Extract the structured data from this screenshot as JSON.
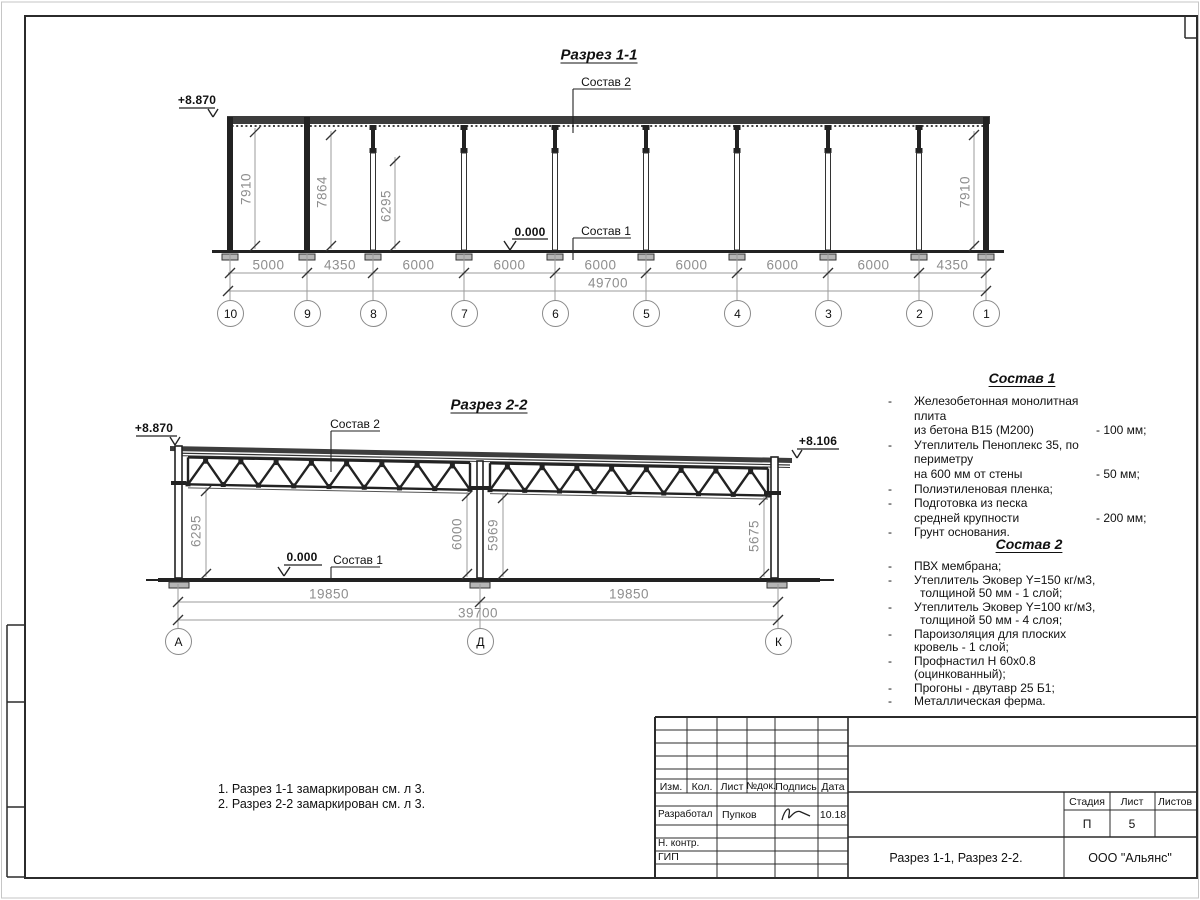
{
  "section1": {
    "title": "Разрез 1-1",
    "elevation_left": "+8.870",
    "zero_level": "0.000",
    "label_sostav2": "Состав 2",
    "label_sostav1": "Состав 1",
    "grid_labels": [
      "10",
      "9",
      "8",
      "7",
      "6",
      "5",
      "4",
      "3",
      "2",
      "1"
    ],
    "segment_dims": [
      "5000",
      "4350",
      "6000",
      "6000",
      "6000",
      "6000",
      "6000",
      "6000",
      "4350"
    ],
    "total_dim": "49700",
    "vertical_dims": [
      "7910",
      "7864",
      "6295",
      "7910"
    ]
  },
  "section2": {
    "title": "Разрез 2-2",
    "elevation_left": "+8.870",
    "elevation_right": "+8.106",
    "zero_level": "0.000",
    "label_sostav2": "Состав 2",
    "label_sostav1": "Состав 1",
    "grid_labels": [
      "А",
      "Д",
      "К"
    ],
    "segment_dims": [
      "19850",
      "19850"
    ],
    "total_dim": "39700",
    "vertical_dims": [
      "6295",
      "6000",
      "5969",
      "5675"
    ]
  },
  "sostav1": {
    "title": "Состав 1",
    "rows": [
      {
        "d": "-",
        "t": "Железобетонная  монолитная плита",
        "v": ""
      },
      {
        "d": "",
        "t": "из бетона В15 (М200)",
        "v": "- 100 мм;"
      },
      {
        "d": "-",
        "t": "Утеплитель Пеноплекс 35, по периметру",
        "v": ""
      },
      {
        "d": "",
        "t": "на 600 мм от стены",
        "v": "- 50 мм;"
      },
      {
        "d": "-",
        "t": "Полиэтиленовая пленка;",
        "v": ""
      },
      {
        "d": "-",
        "t": "Подготовка из песка",
        "v": ""
      },
      {
        "d": "",
        "t": "средней крупности",
        "v": "- 200 мм;"
      },
      {
        "d": "-",
        "t": "Грунт основания.",
        "v": ""
      }
    ]
  },
  "sostav2": {
    "title": "Состав 2",
    "rows": [
      {
        "d": "-",
        "t": "ПВХ мембрана;",
        "v": ""
      },
      {
        "d": "-",
        "t": "Утеплитель Эковер Y=150 кг/м3,",
        "v": ""
      },
      {
        "d": "",
        "t": "толщиной 50 мм - 1 слой;",
        "v": ""
      },
      {
        "d": "-",
        "t": "Утеплитель Эковер Y=100 кг/м3,",
        "v": ""
      },
      {
        "d": "",
        "t": "толщиной 50 мм - 4 слоя;",
        "v": ""
      },
      {
        "d": "-",
        "t": "Пароизоляция для плоских кровель - 1 слой;",
        "v": ""
      },
      {
        "d": "-",
        "t": "Профнастил Н 60х0.8 (оцинкованный);",
        "v": ""
      },
      {
        "d": "-",
        "t": "Прогоны - двутавр 25 Б1;",
        "v": ""
      },
      {
        "d": "-",
        "t": "Металлическая ферма.",
        "v": ""
      }
    ]
  },
  "notes": [
    "1. Разрез 1-1 замаркирован см. л 3.",
    "2. Разрез 2-2 замаркирован см. л 3."
  ],
  "titleblock": {
    "col_izm": "Изм.",
    "col_kol": "Кол.",
    "col_list": "Лист",
    "col_ndok": "№док.",
    "col_podpis": "Подпись",
    "col_data": "Дата",
    "role_developed": "Разработал",
    "developer": "Пупков",
    "date": "10.18",
    "role_ncontr": "Н. контр.",
    "role_gip": "ГИП",
    "stage_label": "Стадия",
    "sheet_label": "Лист",
    "sheets_label": "Листов",
    "stage": "П",
    "sheet_no": "5",
    "doc_title": "Разрез 1-1, Разрез 2-2.",
    "company": "ООО \"Альянс\""
  },
  "colors": {
    "line": "#222222",
    "dim_gray": "#8e8e8e",
    "roof_fill": "#3d3d3d"
  }
}
